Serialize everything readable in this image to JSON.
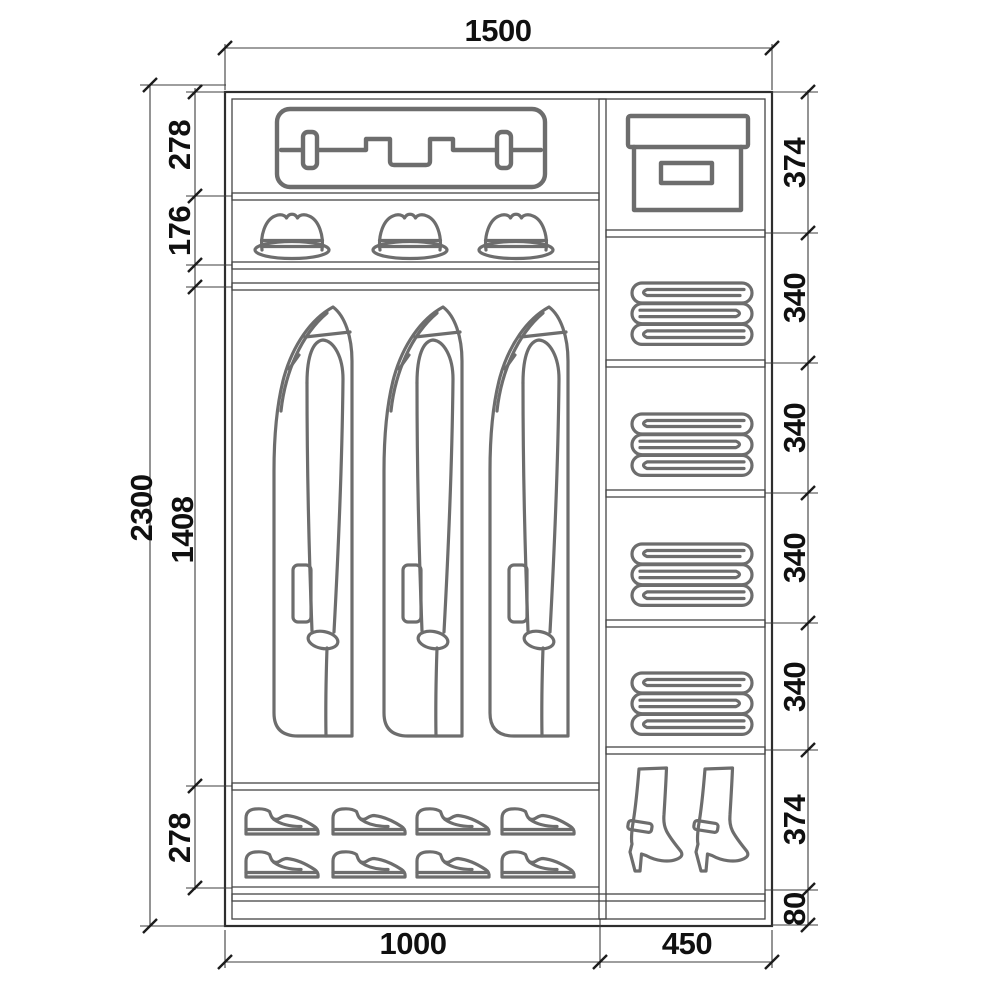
{
  "drawing": {
    "type": "furniture-dimension-diagram",
    "subject": "wardrobe interior layout with dimensions",
    "colors": {
      "background": "#ffffff",
      "frame_line": "#2e2e2e",
      "dimension_line": "#3c3c3c",
      "icon_stroke": "#6d6d6d",
      "label_text": "#101010"
    },
    "dims": {
      "top_width": "1500",
      "overall_height": "2300",
      "left_col": {
        "suitcase_shelf": "278",
        "hat_shelf": "176",
        "hanging_section": "1408",
        "shoe_shelf": "278",
        "width": "1000"
      },
      "right_col": {
        "box_shelf": "374",
        "linen_shelf_1": "340",
        "linen_shelf_2": "340",
        "linen_shelf_3": "340",
        "linen_shelf_4": "340",
        "boot_shelf": "374",
        "plinth": "80",
        "width": "450"
      }
    },
    "icons": {
      "suitcase": "suitcase-icon",
      "hat": "hat-icon",
      "coat": "hanging-coat-icon",
      "shoe": "shoe-icon",
      "storage_box": "storage-box-icon",
      "folded_linen": "folded-linen-icon",
      "boot": "high-heel-boot-icon"
    },
    "counts": {
      "hats": 3,
      "coats": 3,
      "shoes": 8,
      "linen_stacks": 4,
      "boots": 2
    }
  }
}
